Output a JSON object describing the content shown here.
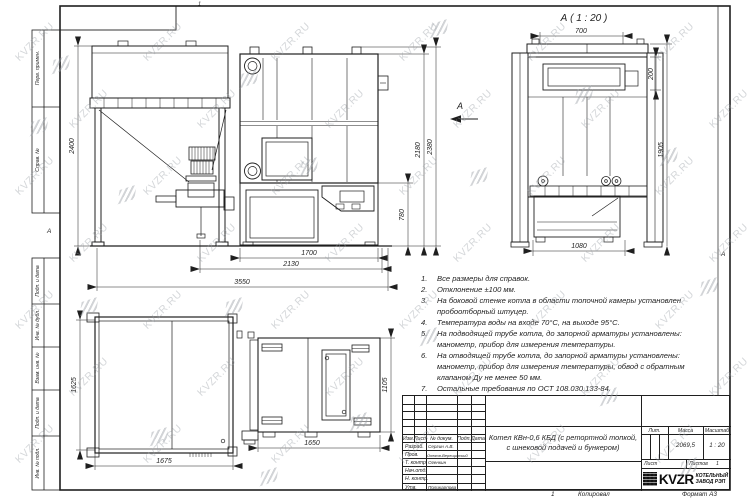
{
  "watermark": {
    "text": "KVZR.RU"
  },
  "sheet": {
    "zone_left": "А",
    "zone_right": "А",
    "top_mark": "1",
    "stamps_top": [
      {
        "label": "Перв. примен."
      },
      {
        "label": "Справ. №"
      }
    ],
    "stamps_bottom": [
      {
        "label": "Подп. и дата"
      },
      {
        "label": "Инв. № дубл."
      },
      {
        "label": "Взам. инв. №"
      },
      {
        "label": "Подп. и дата"
      },
      {
        "label": "Инв. № подл."
      }
    ],
    "footer": {
      "copy_num": "1",
      "copied": "Копировал",
      "format": "Формат А3"
    }
  },
  "views": {
    "front": {
      "dim_height": "2400",
      "dim_body_height": "2180",
      "dim_total_height": "2380",
      "dim_lower": "780",
      "dim_w1": "1700",
      "dim_w2": "2130",
      "dim_total_width": "3550",
      "arrow_label": "А"
    },
    "side": {
      "label": "А ( 1 : 20 )",
      "dim_top": "700",
      "dim_right_small": "200",
      "dim_right_full": "1905",
      "dim_bottom": "1080"
    },
    "plan": {
      "dim_left_height": "1625",
      "dim_left_width": "1675",
      "dim_right_width": "1650",
      "dim_right_height": "1105"
    }
  },
  "notes": {
    "items": [
      {
        "n": "1.",
        "text": "Все размеры для справок."
      },
      {
        "n": "2.",
        "text": "Отклонение ±100 мм."
      },
      {
        "n": "3.",
        "text": "На боковой стенке котла в области топочной камеры установлен пробоотборный штуцер."
      },
      {
        "n": "4.",
        "text": "Температура воды на входе 70°С, на выходе 95°С."
      },
      {
        "n": "5.",
        "text": "На подводящей трубе котла, до запорной арматуры установлены: манометр, прибор для измерения температуры."
      },
      {
        "n": "6.",
        "text": "На отводящей трубе котла, до запорной арматуры установлены: манометр, прибор для измерения температуры, обвод с обратным клапаном Ду не менее 50 мм."
      },
      {
        "n": "7.",
        "text": "Остальные требования по ОСТ 108.030.133-84."
      }
    ]
  },
  "title_block": {
    "rev_header": [
      "Изм.",
      "Лист",
      "№ докум.",
      "Подп.",
      "Дата"
    ],
    "sign_rows": [
      {
        "label": "Разраб.",
        "name": "Сергин А.В."
      },
      {
        "label": "Пров.",
        "name": "Онегов-Верещинский"
      },
      {
        "label": "Т. контр.",
        "name": "Огенкин"
      },
      {
        "label": "Нач.отд.",
        "name": ""
      },
      {
        "label": "Н. контр.",
        "name": ""
      },
      {
        "label": "Утв.",
        "name": "Поликарпова"
      }
    ],
    "doc_title": "Котел КВн-0,6 КБД (с ретортной топкой, с шнековой подачей и бункером)",
    "lit_label": "Лит.",
    "mass_label": "Масса",
    "scale_label": "Масштаб",
    "mass_value": "2069,5",
    "scale_value": "1 : 20",
    "sheet_label": "Лист",
    "sheets_label": "Листов",
    "sheets_value": "1",
    "brand": {
      "name": "KVZR",
      "line1": "КОТЕЛЬНЫЙ",
      "line2": "ЗАВОД РЭП"
    }
  }
}
